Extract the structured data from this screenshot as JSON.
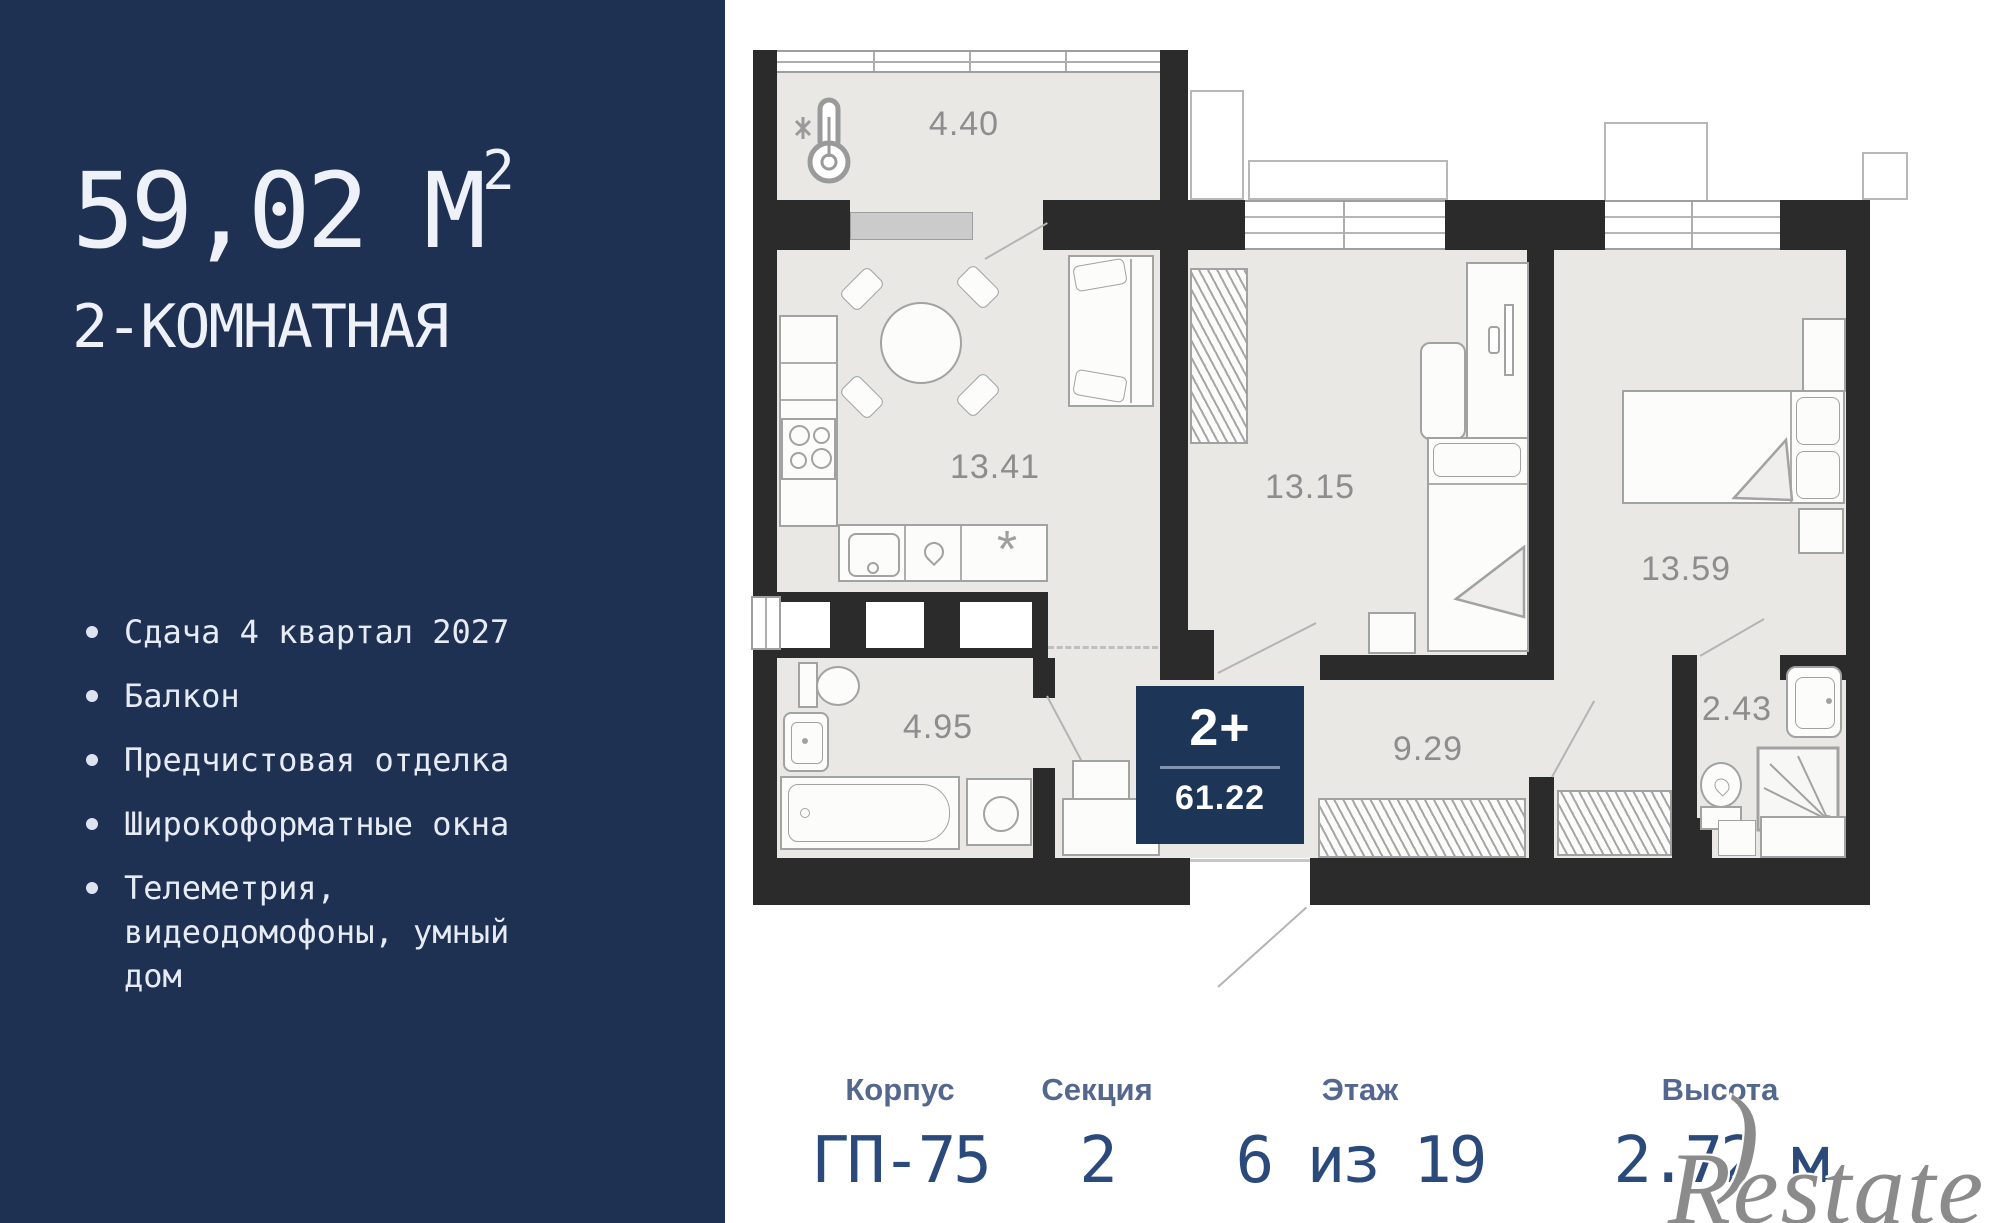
{
  "sidebar": {
    "area": "59,02 М",
    "area_sup": "2",
    "type": "2-КОМНАТНАЯ",
    "features": [
      "Сдача 4 квартал 2027",
      "Балкон",
      "Предчистовая отделка",
      "Широкоформатные окна",
      "Телеметрия, видеодомофоны, умный дом"
    ]
  },
  "plan": {
    "rooms": {
      "balcony": "4.40",
      "kitchen_living": "13.41",
      "bedroom1": "13.15",
      "bedroom2": "13.59",
      "bathroom1": "4.95",
      "hallway": "9.29",
      "bathroom2": "2.43"
    },
    "badge": {
      "type": "2+",
      "area": "61.22"
    }
  },
  "info": [
    {
      "label": "Корпус",
      "value": "ГП-75"
    },
    {
      "label": "Секция",
      "value": "2"
    },
    {
      "label": "Этаж",
      "value": "6 из 19"
    },
    {
      "label": "Высота",
      "value": "2.72 м"
    }
  ],
  "watermark": {
    "paren": ")",
    "text": "Restate"
  },
  "colors": {
    "sidebar_bg": "#1e3153",
    "badge_bg": "#1d3557",
    "wall": "#2b2b2b",
    "floor": "#e9e8e5",
    "value_text": "#2b4a7c"
  }
}
